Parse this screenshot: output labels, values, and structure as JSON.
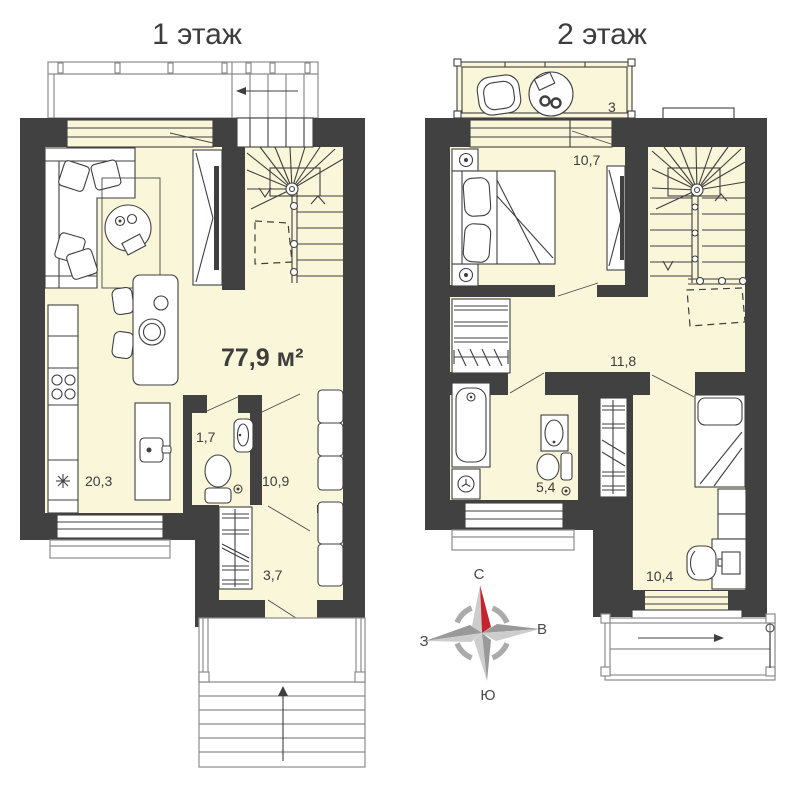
{
  "page": {
    "background": "#ffffff"
  },
  "colors": {
    "wall": "#414141",
    "room_fill": "#faf6da",
    "accent_red": "#c4242b",
    "line": "#3f3f3f"
  },
  "floor1": {
    "title": "1 этаж",
    "total_area": "77,9 м²",
    "rooms": {
      "kitchen_living": "20,3",
      "wc": "1,7",
      "hall": "10,9",
      "closet": "3,7"
    }
  },
  "floor2": {
    "title": "2 этаж",
    "rooms": {
      "balcony": "3",
      "bedroom_top": "10,7",
      "hall": "11,8",
      "bathroom": "5,4",
      "bedroom_bottom": "10,4"
    }
  },
  "compass": {
    "north": "С",
    "east": "В",
    "south": "Ю",
    "west": "З"
  }
}
